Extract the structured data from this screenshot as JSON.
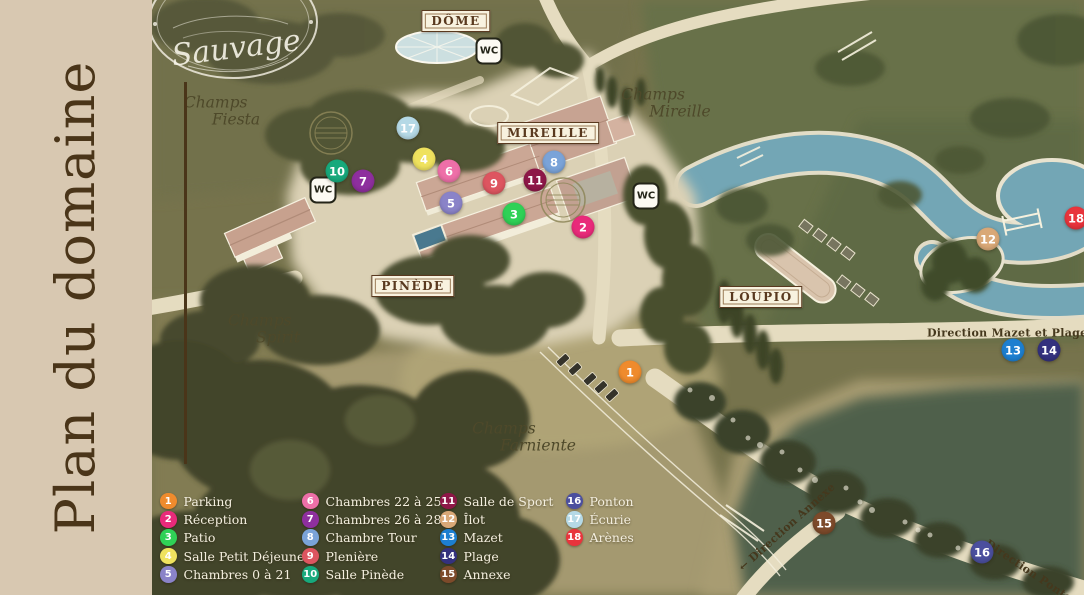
{
  "sidebar": {
    "title": "Plan du domaine"
  },
  "logo": {
    "text": "Sauvage"
  },
  "map": {
    "signs": [
      {
        "label": "DÔME",
        "x": 456,
        "y": 21
      },
      {
        "label": "MIREILLE",
        "x": 548,
        "y": 133
      },
      {
        "label": "PINÈDE",
        "x": 413,
        "y": 286
      },
      {
        "label": "LOUPIO",
        "x": 761,
        "y": 297
      }
    ],
    "wc_label": "WC",
    "wc": [
      {
        "x": 323,
        "y": 190
      },
      {
        "x": 489,
        "y": 51
      },
      {
        "x": 646,
        "y": 196
      }
    ],
    "fields": [
      {
        "line1": "Champs",
        "line2": "Fiesta",
        "x": 222,
        "y": 112
      },
      {
        "line1": "Champs",
        "line2": "Mireille",
        "x": 666,
        "y": 104
      },
      {
        "line1": "Champs",
        "line2": "Spirit",
        "x": 264,
        "y": 330
      },
      {
        "line1": "Champs",
        "line2": "Farniente",
        "x": 524,
        "y": 438
      }
    ],
    "directions": [
      {
        "text": "Direction Mazet et Plage →",
        "x": 1014,
        "y": 333,
        "rotate": 0
      },
      {
        "text": "← Direction Annexe",
        "x": 787,
        "y": 527,
        "rotate": -42
      },
      {
        "text": "Direction Ponton →",
        "x": 1038,
        "y": 577,
        "rotate": 34
      }
    ],
    "markers": [
      {
        "n": 1,
        "x": 630,
        "y": 372,
        "color": "#ef8b2d"
      },
      {
        "n": 2,
        "x": 583,
        "y": 227,
        "color": "#e92a7a"
      },
      {
        "n": 3,
        "x": 514,
        "y": 214,
        "color": "#2fd156"
      },
      {
        "n": 4,
        "x": 424,
        "y": 159,
        "color": "#efe25e"
      },
      {
        "n": 5,
        "x": 451,
        "y": 203,
        "color": "#8a83c8"
      },
      {
        "n": 6,
        "x": 449,
        "y": 171,
        "color": "#ee6fa8"
      },
      {
        "n": 7,
        "x": 363,
        "y": 181,
        "color": "#8e2f9e"
      },
      {
        "n": 8,
        "x": 554,
        "y": 162,
        "color": "#7aa3d8"
      },
      {
        "n": 9,
        "x": 494,
        "y": 183,
        "color": "#dd5560"
      },
      {
        "n": 10,
        "x": 337,
        "y": 171,
        "color": "#17a97c"
      },
      {
        "n": 11,
        "x": 535,
        "y": 180,
        "color": "#8e1748"
      },
      {
        "n": 12,
        "x": 988,
        "y": 239,
        "color": "#d9a877"
      },
      {
        "n": 13,
        "x": 1013,
        "y": 350,
        "color": "#1d7fd0"
      },
      {
        "n": 14,
        "x": 1049,
        "y": 350,
        "color": "#34317e"
      },
      {
        "n": 15,
        "x": 824,
        "y": 523,
        "color": "#7d4a2a"
      },
      {
        "n": 16,
        "x": 982,
        "y": 552,
        "color": "#4b4f9e"
      },
      {
        "n": 17,
        "x": 408,
        "y": 128,
        "color": "#b5d9e6"
      },
      {
        "n": 18,
        "x": 1076,
        "y": 218,
        "color": "#e8343c"
      }
    ]
  },
  "legend": {
    "columns": [
      {
        "x": 160,
        "items": [
          {
            "n": 1,
            "label": "Parking",
            "color": "#ef8b2d"
          },
          {
            "n": 2,
            "label": "Réception",
            "color": "#e92a7a"
          },
          {
            "n": 3,
            "label": "Patio",
            "color": "#2fd156"
          },
          {
            "n": 4,
            "label": "Salle Petit Déjeuner",
            "color": "#efe25e"
          },
          {
            "n": 5,
            "label": "Chambres 0 à 21",
            "color": "#8a83c8"
          }
        ]
      },
      {
        "x": 302,
        "items": [
          {
            "n": 6,
            "label": "Chambres 22 à 25",
            "color": "#ee6fa8"
          },
          {
            "n": 7,
            "label": "Chambres 26 à 28",
            "color": "#8e2f9e"
          },
          {
            "n": 8,
            "label": "Chambre Tour",
            "color": "#7aa3d8"
          },
          {
            "n": 9,
            "label": "Plenière",
            "color": "#dd5560"
          },
          {
            "n": 10,
            "label": "Salle Pinède",
            "color": "#17a97c"
          }
        ]
      },
      {
        "x": 440,
        "items": [
          {
            "n": 11,
            "label": "Salle de Sport",
            "color": "#8e1748"
          },
          {
            "n": 12,
            "label": "Îlot",
            "color": "#d9a877"
          },
          {
            "n": 13,
            "label": "Mazet",
            "color": "#1d7fd0"
          },
          {
            "n": 14,
            "label": "Plage",
            "color": "#34317e"
          },
          {
            "n": 15,
            "label": "Annexe",
            "color": "#7d4a2a"
          }
        ]
      },
      {
        "x": 566,
        "items": [
          {
            "n": 16,
            "label": "Ponton",
            "color": "#4b4f9e"
          },
          {
            "n": 17,
            "label": "Écurie",
            "color": "#b5d9e6"
          },
          {
            "n": 18,
            "label": "Arènes",
            "color": "#e8343c"
          }
        ]
      }
    ]
  }
}
